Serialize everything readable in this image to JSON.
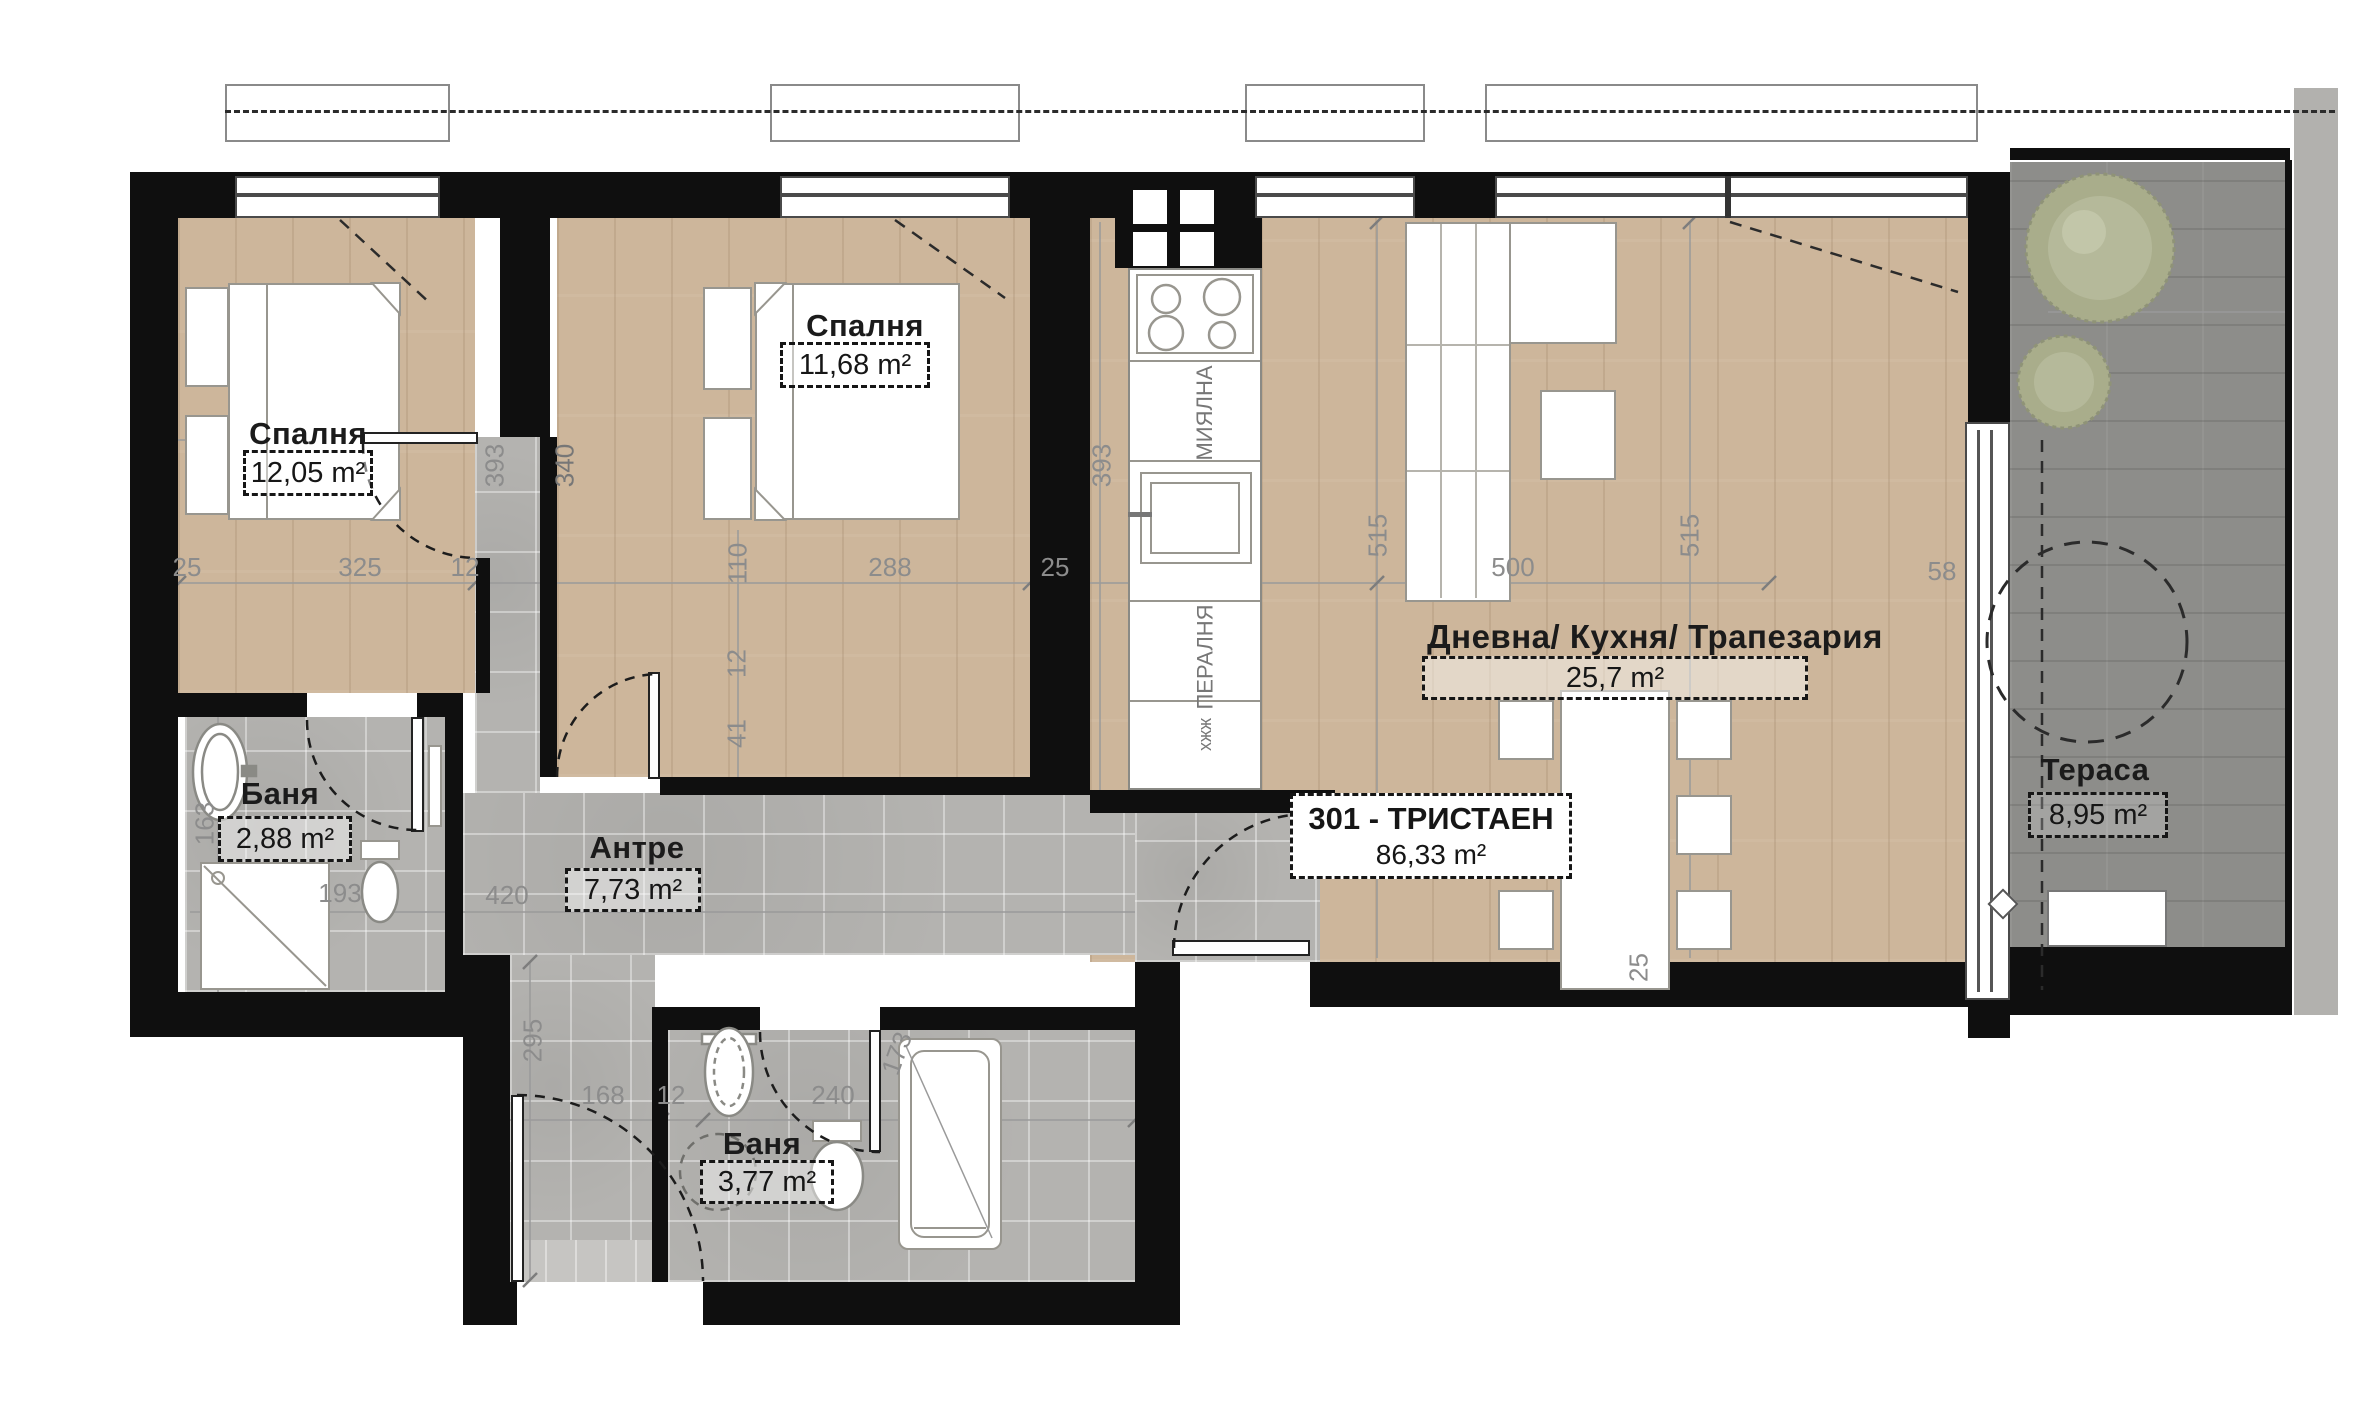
{
  "unit": {
    "name": "301 - ТРИСТАЕН",
    "area": "86,33 m²"
  },
  "rooms": {
    "bedroom1": {
      "name": "Спалня",
      "area": "12,05 m²"
    },
    "bedroom2": {
      "name": "Спалня",
      "area": "11,68 m²"
    },
    "living": {
      "name": "Дневна/ Кухня/ Трапезария",
      "area": "25,7 m²"
    },
    "bath1": {
      "name": "Баня",
      "area": "2,88 m²"
    },
    "hall": {
      "name": "Антре",
      "area": "7,73 m²"
    },
    "bath2": {
      "name": "Баня",
      "area": "3,77 m²"
    },
    "terrace": {
      "name": "Тераса",
      "area": "8,95 m²"
    }
  },
  "appliances": {
    "dishwasher": "МИЯЛНА",
    "washing_machine": "ПЕРАЛНЯ",
    "misc": "хжж"
  },
  "dims": {
    "top_chain": [
      "25",
      "325",
      "12",
      "288",
      "25",
      "500"
    ],
    "vertical_left_pair": [
      "393",
      "340"
    ],
    "vertical_bed2": "393",
    "vertical_living": [
      "515",
      "515"
    ],
    "terrace_door": "58",
    "bath1_side": [
      "163",
      "193"
    ],
    "hall_chain": [
      "420",
      "295"
    ],
    "mid_chain": [
      "110",
      "12",
      "41"
    ],
    "bottom_chain": [
      "168",
      "12",
      "240"
    ],
    "bath2_diagonal": "173",
    "living_bottom": "25"
  },
  "colors": {
    "wall": "#0f0f0f",
    "wood_floor": "#cdb69b",
    "tile_floor": "#b4b3b0",
    "terrace_deck": "#8d8d8a",
    "shrub_green": "#a9ad8b",
    "dimension_text": "#8c8c8c",
    "fixture_stroke": "#98968f"
  }
}
